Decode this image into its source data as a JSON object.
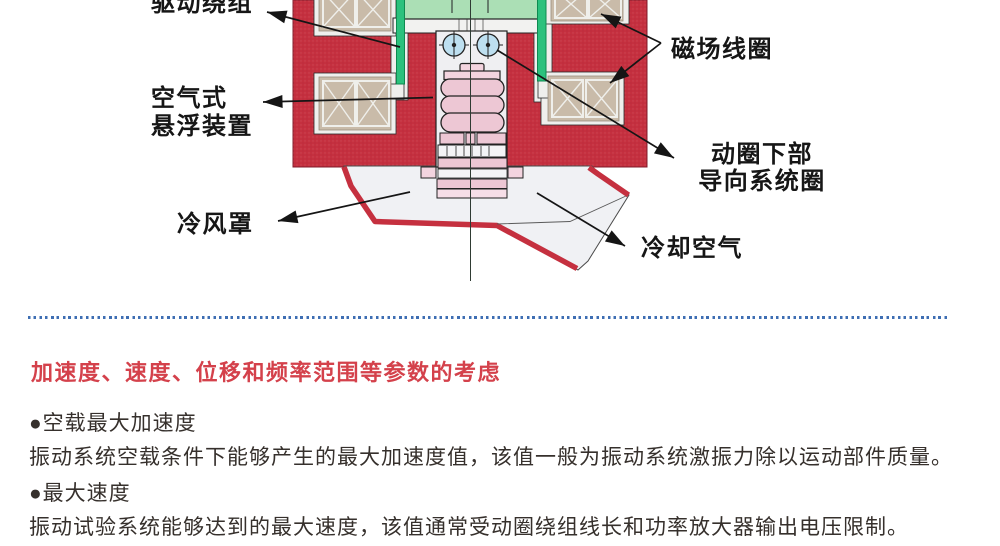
{
  "diagram": {
    "labels": {
      "drive_winding": "驱动绕组",
      "field_coil": "磁场线圈",
      "air_suspension_line1": "空气式",
      "air_suspension_line2": "悬浮装置",
      "guide_system_line1": "动圈下部",
      "guide_system_line2": "导向系统圈",
      "cooling_hood": "冷风罩",
      "cooling_air": "冷却空气"
    },
    "colors": {
      "magnet_body_red": "#c5303f",
      "field_coil_tan": "#c9bba9",
      "drive_winding_green": "#2bc17d",
      "table_green": "#abdfb5",
      "roller_blue": "#bddff0",
      "suspension_pink": "#edc7d4",
      "hood_fill": "#f0f1f4"
    }
  },
  "divider": {
    "color": "#3e6eb3"
  },
  "section": {
    "heading": "加速度、速度、位移和频率范围等参数的考虑",
    "heading_color": "#d4414b",
    "items": [
      {
        "title": "●空载最大加速度",
        "desc": "振动系统空载条件下能够产生的最大加速度值，该值一般为振动系统激振力除以运动部件质量。"
      },
      {
        "title": "●最大速度",
        "desc": "振动试验系统能够达到的最大速度，该值通常受动圈绕组线长和功率放大器输出电压限制。"
      }
    ]
  }
}
